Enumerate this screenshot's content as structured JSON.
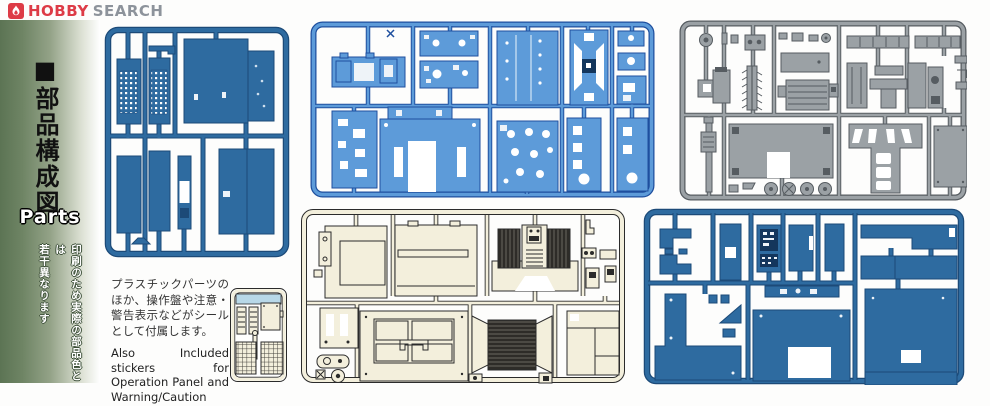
{
  "header": {
    "brand": {
      "word1": "HOBBY",
      "word2": "SEARCH"
    },
    "logo_icon": "flame-icon"
  },
  "sidebar": {
    "marker": "■",
    "title_vertical": "部品構成図",
    "title_en": "Parts",
    "disclaimer_line1": "印刷のため実際の部品色とは",
    "disclaimer_line2": "若干異なります"
  },
  "notes": {
    "jp": "プラスチックパーツのほか、操作盤や注意・警告表示などがシールとして付属します。",
    "en": "Also Included stickers for Operation Panel and Warning/Caution labels."
  },
  "sprues": {
    "panel_a": {
      "molded_color": "steel blue",
      "hex": "#2e6ba0",
      "content": "large wall panels and perforated grilles"
    },
    "panel_b": {
      "molded_color": "bright blue",
      "hex": "#5d9bd9",
      "content": "chassis plates, frames and brackets"
    },
    "panel_c": {
      "molded_color": "gray",
      "hex": "#9ba1a5",
      "content": "auger, shafts, pulleys, mechanism parts"
    },
    "panel_d": {
      "molded_color": "cream",
      "hex": "#f3efdc",
      "content": "body panels, engine block and radiator grilles"
    },
    "panel_e": {
      "molded_color": "steel blue",
      "hex": "#2e6ba0",
      "content": "floor plates and large body panels"
    },
    "panel_f": {
      "molded_color": "cream",
      "hex": "#f3efdc",
      "content": "small sprue with ladders and mesh grilles"
    }
  },
  "palette": {
    "logo_red": "#dd3b46",
    "steel_blue": "#2e6ba0",
    "steel_blue_dark": "#1c4a78",
    "bright_blue": "#5d9bd9",
    "bright_blue_dark": "#1e4f9e",
    "part_gray": "#9ba1a5",
    "gray_dark": "#565c61",
    "cream": "#f3efdc",
    "ink": "#2b2b2b",
    "light_blue": "#b8d8e8",
    "sidebar_green": "#5c7454"
  }
}
